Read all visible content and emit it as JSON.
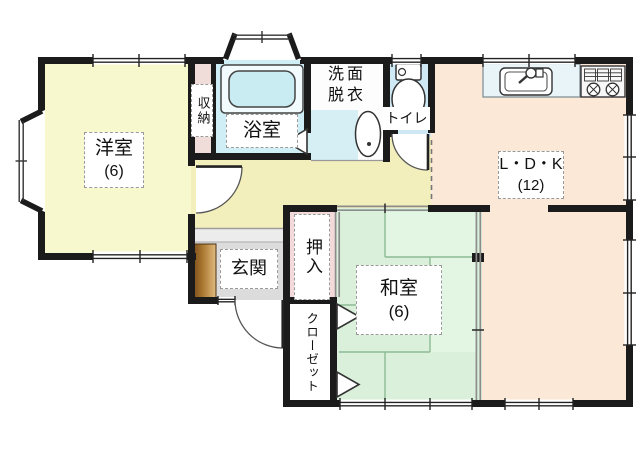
{
  "floorplan": {
    "rooms": {
      "western_room": {
        "name": "洋室",
        "size": "(6)"
      },
      "storage": {
        "name": "収納"
      },
      "bathroom": {
        "name": "浴室"
      },
      "washroom": {
        "name_top": "洗面",
        "name_bottom": "脱衣"
      },
      "toilet": {
        "name": "トイレ"
      },
      "ldk": {
        "name": "L・D・K",
        "size": "(12)"
      },
      "entrance": {
        "name": "玄関"
      },
      "oshiire": {
        "name": "押入"
      },
      "japanese_room": {
        "name": "和室",
        "size": "(6)"
      },
      "closet": {
        "name": "クローゼット"
      }
    },
    "colors": {
      "wall": "#1b1b1b",
      "western_room_floor": "#f8f8cf",
      "hallway_floor": "#f3efbc",
      "bathroom_floor": "#cfeef5",
      "bathtub_fill": "#c9ecf3",
      "washroom_accent": "#d5eff5",
      "toilet_floor": "#cfe9f4",
      "ldk_floor": "#fbe8d7",
      "japanese_room_floor": "#daf0da",
      "oshiire_floor": "#f3dada",
      "storage_floor": "#f0dcd9",
      "entrance_floor": "#dcdcdc",
      "kitchen_counter": "#e8f4f8",
      "shoe_cabinet": "#a9772f"
    }
  }
}
